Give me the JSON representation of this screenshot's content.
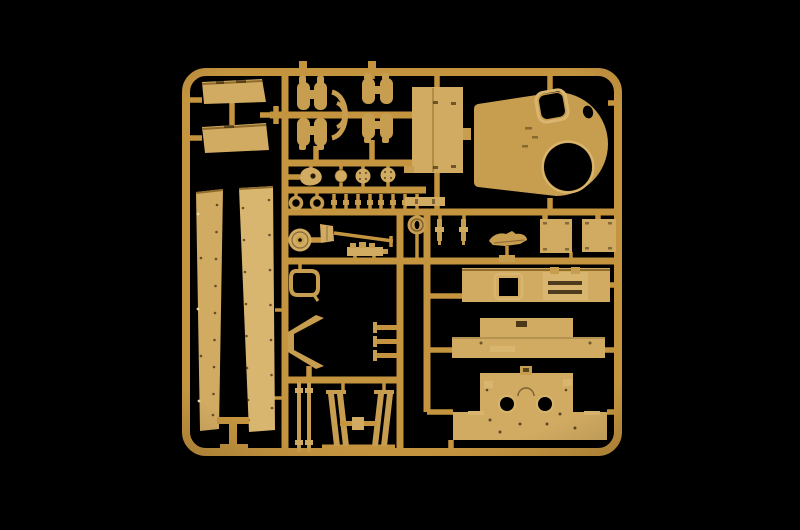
{
  "scene": {
    "subject": "tan-plastic-model-kit-sprue-on-black"
  },
  "colors": {
    "background": "#000000",
    "runner": "#c4943f",
    "part-mid": "#c79d4f",
    "part-light": "#d2ab62",
    "part-lighter": "#d9b66f",
    "detail-dark": "#2a1c08",
    "hole": "#000000",
    "highlight": "#ecd9a0"
  },
  "parts": [
    {
      "name": "sprue-frame",
      "count": 1
    },
    {
      "name": "stowage-bin",
      "count": 2
    },
    {
      "name": "periscope-pair",
      "count": 4
    },
    {
      "name": "curved-hose",
      "count": 2
    },
    {
      "name": "radiator-box",
      "count": 1
    },
    {
      "name": "turret-roof",
      "count": 1
    },
    {
      "name": "side-skirt-panel",
      "count": 2
    },
    {
      "name": "teardrop-part",
      "count": 1
    },
    {
      "name": "gauge-wheel",
      "count": 3
    },
    {
      "name": "towing-ring",
      "count": 2
    },
    {
      "name": "bolt-stud",
      "count": 8
    },
    {
      "name": "road-wheel",
      "count": 1
    },
    {
      "name": "shovel",
      "count": 1
    },
    {
      "name": "mg-strip",
      "count": 1
    },
    {
      "name": "hatch-loop",
      "count": 1
    },
    {
      "name": "v-bracket",
      "count": 1
    },
    {
      "name": "t-bar",
      "count": 3
    },
    {
      "name": "idler-wheel",
      "count": 1
    },
    {
      "name": "small-bar",
      "count": 1
    },
    {
      "name": "hanging-pin",
      "count": 2
    },
    {
      "name": "exhaust-part",
      "count": 1
    },
    {
      "name": "flat-plate",
      "count": 2
    },
    {
      "name": "glacis-panel",
      "count": 1
    },
    {
      "name": "superstructure-panel",
      "count": 1
    },
    {
      "name": "hull-bottom-panel",
      "count": 1
    },
    {
      "name": "support-rod",
      "count": 2
    },
    {
      "name": "slanted-strut",
      "count": 4
    },
    {
      "name": "connector-block",
      "count": 1
    }
  ]
}
